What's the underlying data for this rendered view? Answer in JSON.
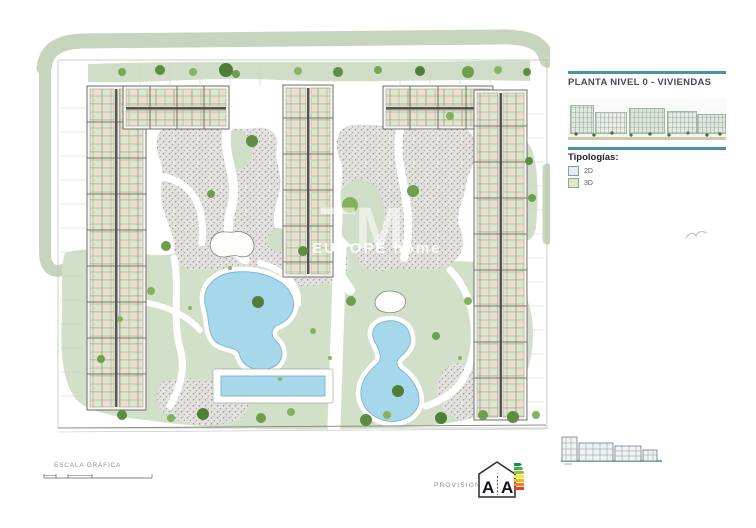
{
  "sidebar": {
    "title": "PLANTA NIVEL 0 - VIVIENDAS",
    "typologies_heading": "Tipologías:",
    "legend": [
      {
        "label": "2D",
        "swatch_style": "background:#e6ecf2;border:1px solid #8a99a8"
      },
      {
        "label": "3D",
        "swatch_style": "background:#dbe8ca;border:1px solid #93a886"
      }
    ]
  },
  "footer": {
    "scale_label": "ESCALA GRÁFICA",
    "provisional_label": "PROVISIONAL"
  },
  "energy_badge": {
    "letter_left": "A",
    "letter_right": "A"
  },
  "watermark": {
    "logo": "TM",
    "text": "EUROPE home"
  },
  "colors": {
    "accent_teal": "#4695a0",
    "lawn_green": "#d2dfc9",
    "road_green": "#c7d5bf",
    "pool_blue": "#a6d7ea",
    "gravel_gray": "#e3e2de",
    "tree_green": "#5d8c42"
  }
}
